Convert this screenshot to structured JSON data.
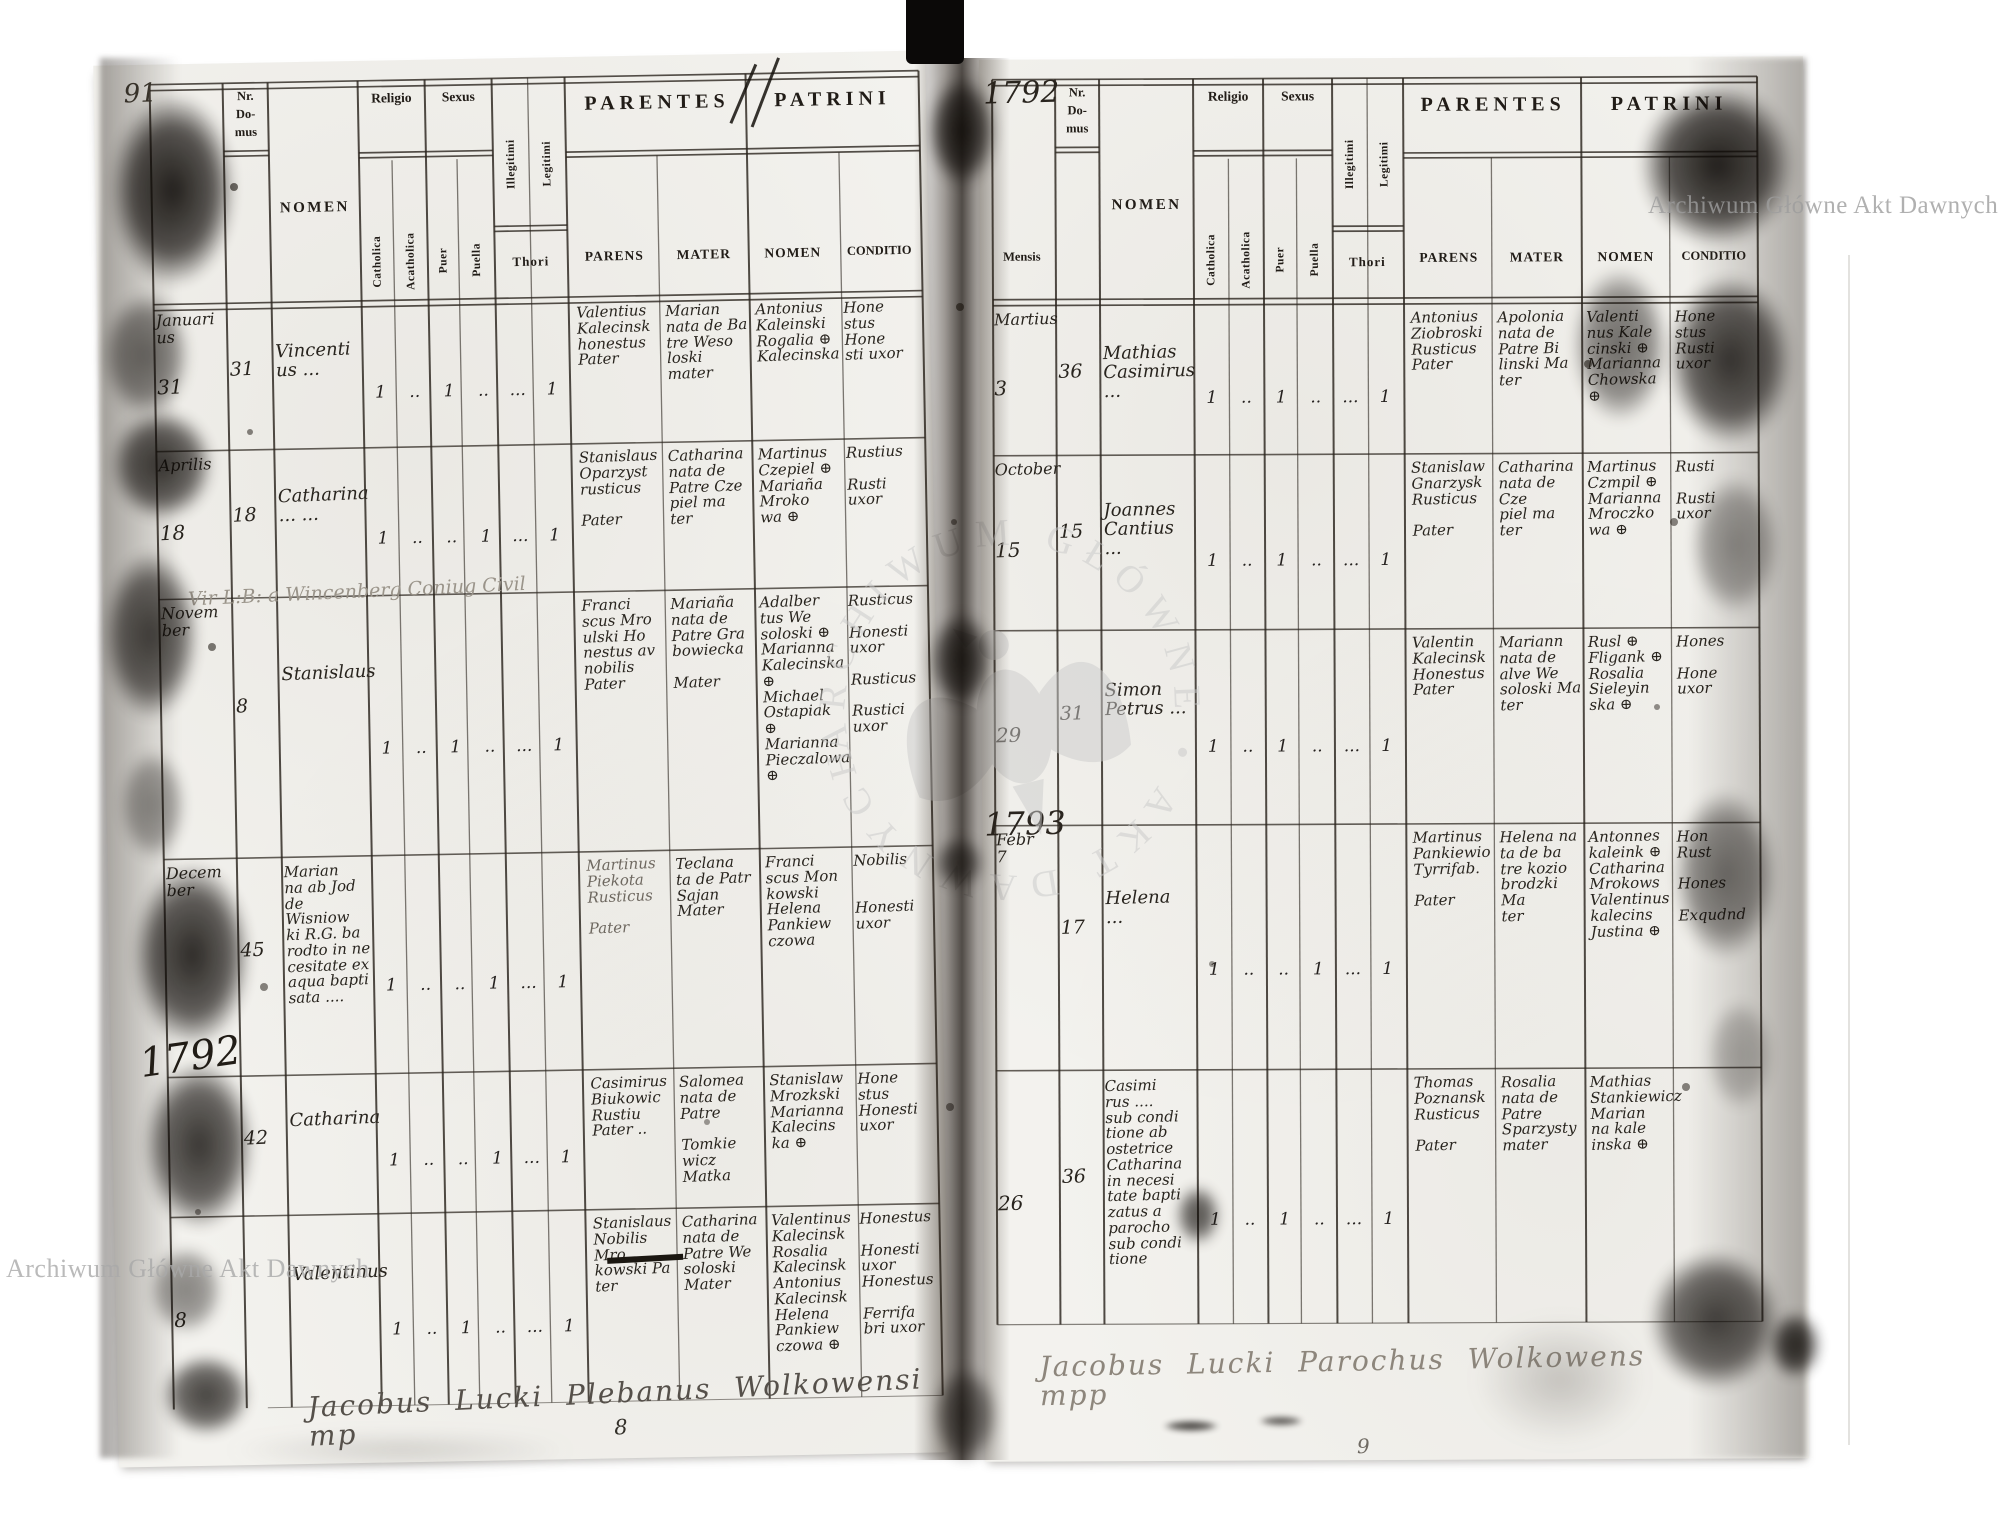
{
  "watermark": {
    "text": "Archiwum Główne Akt Dawnych",
    "seal_text": "ARCHIWUM GŁÓWNE • AKT DAWNYCH •"
  },
  "column_headers": {
    "mensis": "Mensis",
    "nr": "Nr.\nDo-\nmus",
    "nomen": "NOMEN",
    "religio": "Religio",
    "sexus": "Sexus",
    "catholica": "Catholica",
    "acatholica": "Acatholica",
    "puer": "Puer",
    "puella": "Puella",
    "illegitimi": "Illegitimi",
    "legitimi": "Legitimi",
    "thori": "Thori",
    "parentes": "PARENTES",
    "parens": "PARENS",
    "mater": "MATER",
    "patrini": "PATRINI",
    "patrini_nomen": "NOMEN",
    "conditio": "CONDITIO"
  },
  "left_page": {
    "year_top": "91",
    "marginal_year": "1792",
    "note": "Vir L:B: a Wincenberg  Coniug  Civil",
    "signature": "Jacobus Lucki Plebanus Wolkowensi mp",
    "page_number": "8",
    "rows": [
      {
        "month": "Januari\nus",
        "day": "31",
        "nr": "31",
        "nomen": "Vincenti\nus ...",
        "ticks": [
          "1",
          "..",
          "1",
          "..",
          "...",
          "1"
        ],
        "parens": "Valentius\nKalecinsk\nhonestus\nPater",
        "mater": "Marian\nnata de Ba\ntre Weso\nloski mater",
        "patrini": "Antonius\nKaleinski\nRogalia ⊕\nKalecinska",
        "conditio": "Hone\nstus\nHone\nsti uxor"
      },
      {
        "month": "Aprilis",
        "day": "18",
        "nr": "18",
        "nomen": "Catharina\n... ...",
        "ticks": [
          "1",
          "..",
          "..",
          "1",
          "...",
          "1"
        ],
        "parens": "Stanislaus\nOparzyst\nrusticus\n\nPater",
        "mater": "Catharina\nnata de\nPatre Cze\npiel ma\nter",
        "patrini": "Martinus\nCzepiel ⊕\nMariaña\nMroko\nwa ⊕",
        "conditio": "Rustius\n\nRusti\nuxor"
      },
      {
        "month": "Novem\nber",
        "day": "",
        "nr": "8",
        "nomen": "Stanislaus",
        "ticks": [
          "1",
          "..",
          "1",
          "..",
          "...",
          "1"
        ],
        "parens": "Franci\nscus Mro\nulski Ho\nnestus av\nnobilis\nPater",
        "mater": "Mariaña\nnata de\nPatre Gra\nbowiecka\n\nMater",
        "patrini": "Adalber\ntus We\nsoloski ⊕\nMarianna\nKalecinska ⊕\nMichael\nOstapiak ⊕\nMarianna\nPieczalowa ⊕",
        "conditio": "Rusticus\n\nHonesti\nuxor\n\nRusticus\n\nRustici\nuxor"
      },
      {
        "month": "Decem\nber",
        "day": "",
        "nr": "45",
        "nomen": "Marian\nna ab Jod\nde Wisniow\nki R.G. ba\nrodto in ne\ncesitate ex\naqua bapti\nsata ....",
        "ticks": [
          "1",
          "..",
          "..",
          "1",
          "...",
          "1"
        ],
        "parens": "Martinus\nPiekota\nRusticus\n\nPater",
        "mater": "Teclana\nta de Patr\nSajan\nMater",
        "patrini": "Franci\nscus Mon\nkowski\nHelena\nPankiew\nczowa",
        "conditio": "Nobilis\n\n\nHonesti\nuxor"
      },
      {
        "month": "",
        "day": "",
        "nr": "42",
        "nomen": "Catharina",
        "ticks": [
          "1",
          "..",
          "..",
          "1",
          "...",
          "1"
        ],
        "parens": "Casimirus\nBiukowic\nRustiu\nPater ..",
        "mater": "Salomea\nnata de\nPatre\n\nTomkie\nwicz Matka",
        "patrini": "Stanislaw\nMrozkski\nMarianna\nKalecins\nka ⊕",
        "conditio": "Hone\nstus\nHonesti\nuxor"
      },
      {
        "month": "",
        "day": "8",
        "nr": "",
        "nomen": "Valentinus",
        "ticks": [
          "1",
          "..",
          "1",
          "..",
          "...",
          "1"
        ],
        "parens": "Stanislaus\nNobilis Mro\nkowski Pa\nter",
        "mater": "Catharina\nnata de\nPatre We\nsoloski\nMater",
        "patrini": "Valentinus\nKalecinsk\nRosalia\nKalecinsk\nAntonius\nKalecinsk\nHelena\nPankiew\nczowa ⊕",
        "conditio": "Honestus\n\nHonesti\nuxor\nHonestus\n\nFerrifa\nbri uxor"
      }
    ]
  },
  "right_page": {
    "year_top": "1792",
    "marginal_year": "1793",
    "signature": "Jacobus Lucki Parochus Wolkowens mpp",
    "page_number": "9",
    "rows": [
      {
        "month": "Martius",
        "day": "3",
        "nr": "36",
        "nomen": "Mathias\nCasimirus ...",
        "ticks": [
          "1",
          "..",
          "1",
          "..",
          "...",
          "1"
        ],
        "parens": "Antonius\nZiobroski\nRusticus\nPater",
        "mater": "Apolonia\nnata de\nPatre Bi\nlinski Ma\nter",
        "patrini": "Valenti\nnus Kale\ncinski ⊕\nMarianna\nChowska ⊕",
        "conditio": "Hone\nstus\nRusti\nuxor"
      },
      {
        "month": "October",
        "day": "15",
        "nr": "15",
        "nomen": "Joannes\nCantius ...",
        "ticks": [
          "1",
          "..",
          "1",
          "..",
          "...",
          "1"
        ],
        "parens": "Stanislaw\nGnarzysk\nRusticus\n\nPater",
        "mater": "Catharina\nnata de Cze\npiel ma\nter",
        "patrini": "Martinus\nCzmpil ⊕\nMarianna\nMroczko\nwa ⊕",
        "conditio": "Rusti\n\nRusti\nuxor"
      },
      {
        "month": "",
        "day": "29",
        "nr": "31",
        "nomen": "Simon\nPetrus ...",
        "ticks": [
          "1",
          "..",
          "1",
          "..",
          "...",
          "1"
        ],
        "parens": "Valentin\nKalecinsk\nHonestus\nPater",
        "mater": "Mariann\nnata de\nalve We\nsoloski Ma\nter",
        "patrini": "Rusl ⊕\nFligank ⊕\nRosalia\nSieleyin\nska ⊕",
        "conditio": "Hones\n\nHone\nuxor"
      },
      {
        "month": "Febr\n7",
        "day": "",
        "nr": "17",
        "nomen": "Helena ...",
        "ticks": [
          "1",
          "..",
          "..",
          "1",
          "...",
          "1"
        ],
        "parens": "Martinus\nPankiewio\nTyrrifab.\n\nPater",
        "mater": "Helena na\nta de ba\ntre kozio\nbrodzki Ma\nter",
        "patrini": "Antonnes\nkaleink ⊕\nCatharina\nMrokows\nValentinus\nkalecins\nJustina ⊕",
        "conditio": "Hon\nRust\n\nHones\n\nExqudnd"
      },
      {
        "month": "",
        "day": "26",
        "nr": "36",
        "nomen": "Casimi\nrus ....\nsub condi\ntione ab\nostetrice\nCatharina\nin necesi\ntate bapti\nzatus a\nparocho\nsub condi\ntione",
        "ticks": [
          "1",
          "..",
          "1",
          "..",
          "...",
          "1"
        ],
        "parens": "Thomas\nPoznansk\nRusticus\n\nPater",
        "mater": "Rosalia\nnata de\nPatre\nSparzysty\nmater",
        "patrini": "Mathias\nStankiewicz\nMarian\nna kale\ninska ⊕",
        "conditio": ""
      }
    ]
  }
}
